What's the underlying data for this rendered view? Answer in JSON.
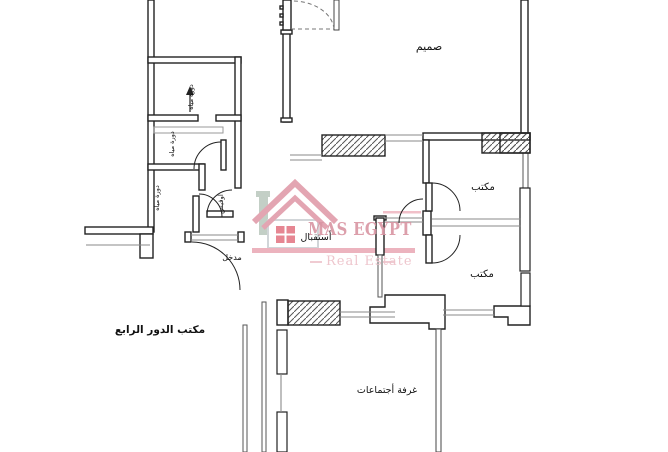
{
  "plan": {
    "title_label": "مكتب الدور الرابع",
    "rooms": {
      "design": "صميم",
      "reception": "أستقبال",
      "entrance": "مدخل",
      "office_upper": "مكتب",
      "office_lower": "مكتب",
      "meeting": "غرفة أجتماعات",
      "bathroom_top": "دورة مياه",
      "bathroom_mid": "دورة مياه",
      "bathroom_low": "دورة مياه",
      "pantry": "اوفيس"
    }
  },
  "watermark": {
    "brand": "MAS EGYPT",
    "tagline": "Real Estate"
  },
  "colors": {
    "wall": "#222222",
    "thin_line": "#8a8a8a",
    "watermark_pink": "#de95a4",
    "watermark_band": "#e9a6b3",
    "watermark_light": "#eec3cb",
    "background": "#ffffff"
  }
}
